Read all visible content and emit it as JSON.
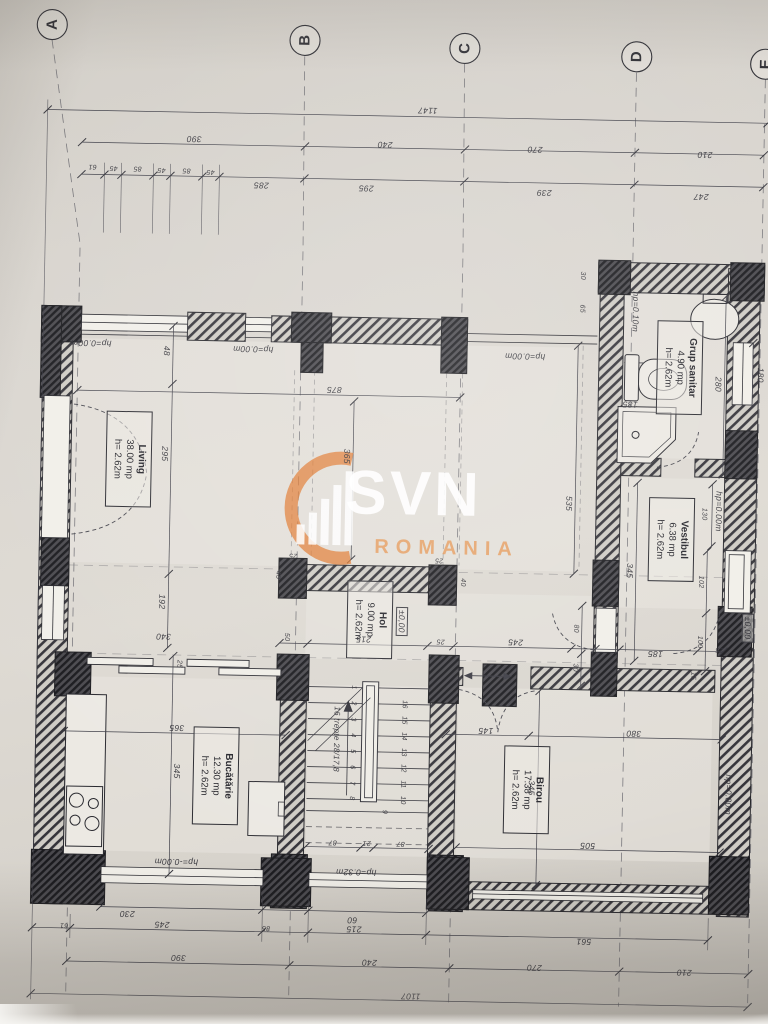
{
  "grid": {
    "cols": [
      "A",
      "B",
      "C",
      "D",
      "E"
    ]
  },
  "watermark": {
    "brand": "SVN",
    "region": "ROMANIA"
  },
  "rooms": {
    "living": {
      "name": "Living",
      "area": "38.00 mp",
      "height": "h= 2.62m"
    },
    "hol": {
      "name": "Hol",
      "area": "9.00 mp",
      "height": "h= 2.62m"
    },
    "bucatarie": {
      "name": "Bucătărie",
      "area": "12.30 mp",
      "height": "h= 2.62m"
    },
    "birou": {
      "name": "Birou",
      "area": "17.38 mp",
      "height": "h= 2.62m"
    },
    "vestibul": {
      "name": "Vestibul",
      "area": "6.38 mp",
      "height": "h= 2.62m"
    },
    "grup_sanitar": {
      "name": "Grup sanitar",
      "area": "4.90 mp",
      "height": "h= 2.62m"
    }
  },
  "levels": {
    "zero": "±0,00",
    "hp0": "hp=0.00m",
    "hp0neg": "hp=-0.00m",
    "hp010": "hp=0.10m",
    "hp032": "hp=0.32m"
  },
  "stairs": {
    "note": "16 trepte 28/17,8",
    "steps": [
      "1",
      "2",
      "3",
      "4",
      "5",
      "6",
      "7",
      "8",
      "9",
      "10",
      "11",
      "12",
      "13",
      "14",
      "15",
      "16"
    ]
  },
  "dims": {
    "top": {
      "total": "1147",
      "ab": "390",
      "bc": "240",
      "cd": "270",
      "de": "210",
      "chain": [
        "61",
        "45",
        "85",
        "45",
        "85",
        "45"
      ],
      "r3": [
        "285",
        "295",
        "239",
        "247"
      ]
    },
    "bottom": {
      "kwin": "230",
      "swin": "60",
      "c61": "61",
      "c245": "245",
      "c85": "85",
      "c215": "215",
      "c561": "561",
      "ab": "390",
      "bc": "240",
      "cd": "270",
      "de": "210",
      "total": "1107"
    },
    "left": {
      "a48": "48",
      "a295": "295",
      "a192": "192",
      "a340": "340"
    },
    "living": {
      "w875": "875",
      "h365": "365",
      "h535": "535"
    },
    "kitchen": {
      "w365": "365",
      "h345": "345",
      "c25": "25"
    },
    "hol": {
      "c50": "50",
      "w215": "215",
      "c25a": "25",
      "w245": "245",
      "v40a": "40",
      "v40b": "40",
      "p25a": "25",
      "p25b": "25"
    },
    "vestibul": {
      "w345": "345",
      "v80": "80",
      "v30": "30",
      "v130": "130",
      "v102": "102",
      "v100": "100",
      "w185": "185",
      "v15": "15"
    },
    "gs": {
      "v30": "30",
      "v65": "65",
      "v280": "280",
      "w185": "185",
      "v180": "180"
    },
    "birou": {
      "w145": "145",
      "w380": "380",
      "h345": "345",
      "w505": "505",
      "c25b": "25"
    },
    "stairs": {
      "a": "87",
      "b": "21",
      "c": "87"
    }
  }
}
